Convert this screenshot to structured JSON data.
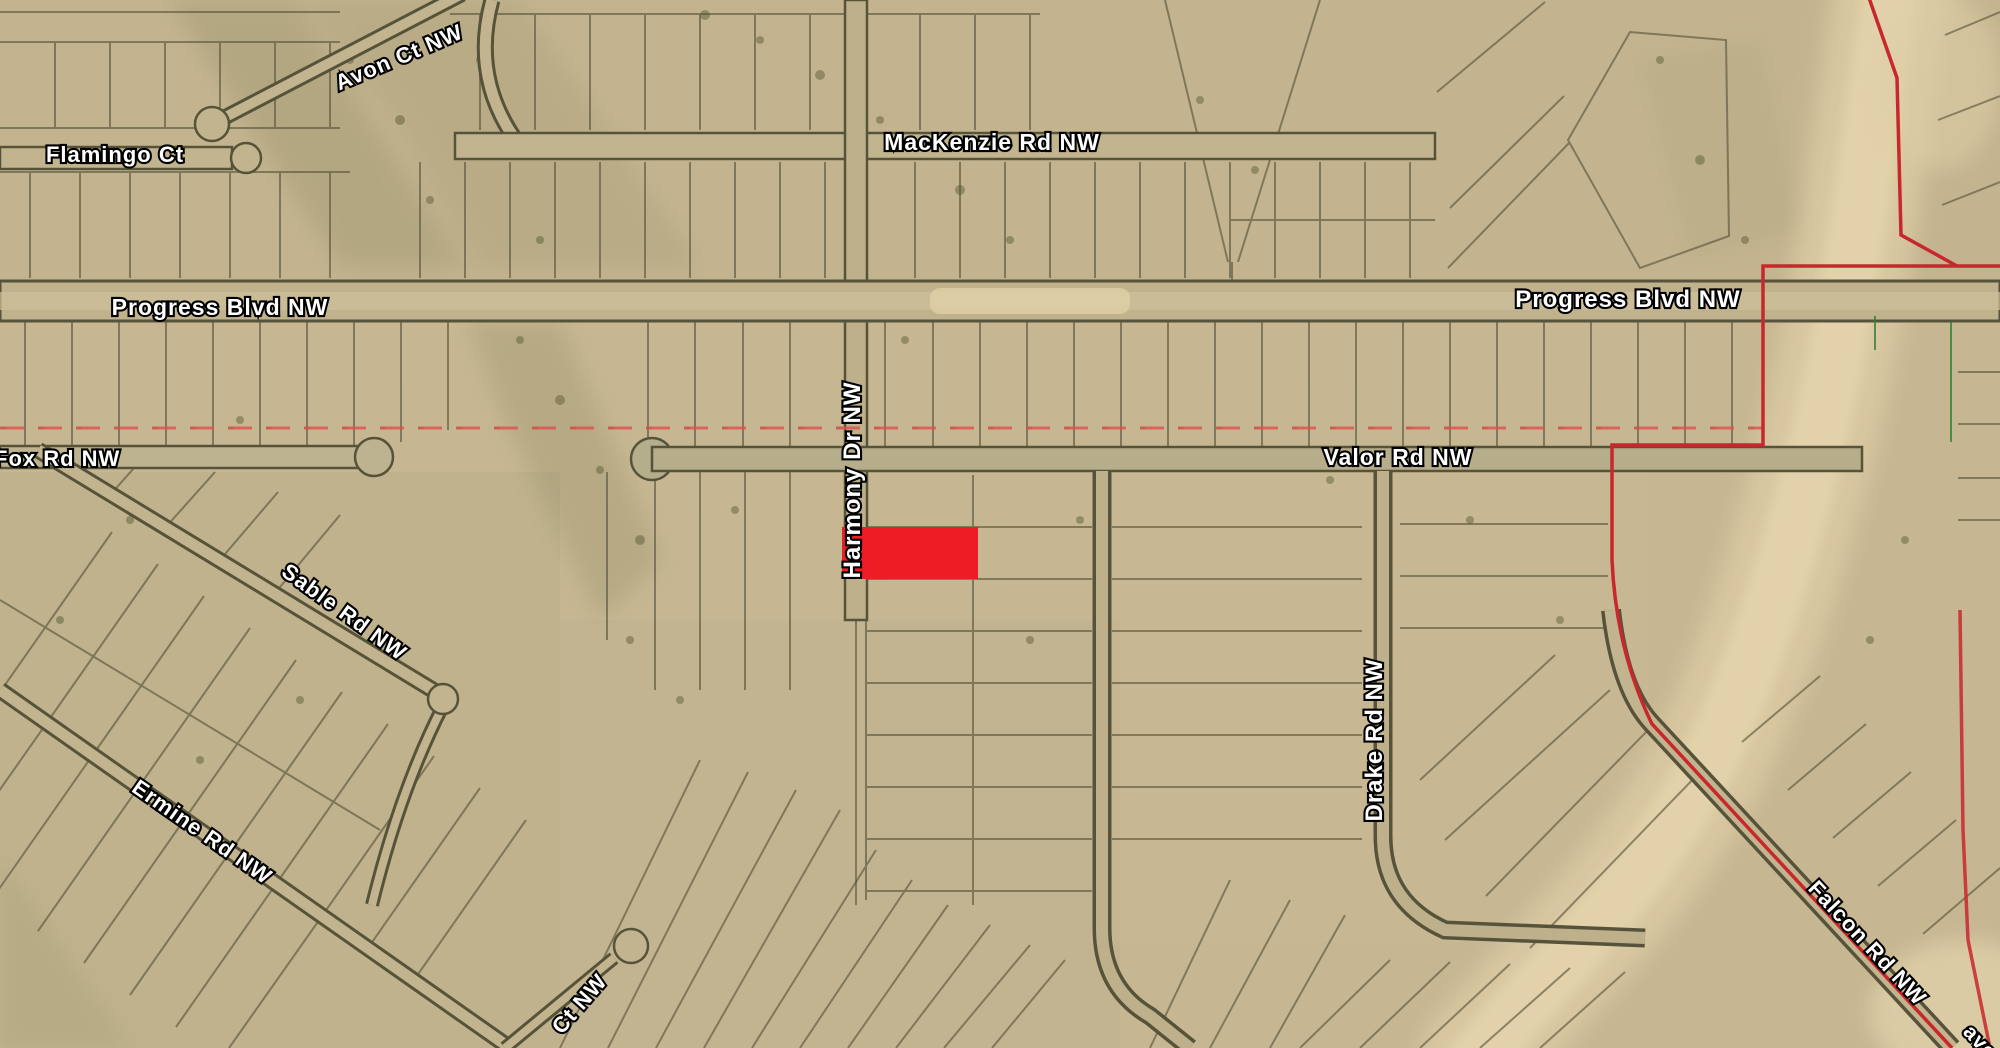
{
  "map": {
    "description": "aerial parcel plat map with highlighted lot",
    "highlight_color": "#ee1c24",
    "boundary_color": "#c8272c",
    "section_line_color": "#e0504e",
    "survey_tick_color": "#2f8032",
    "labels": {
      "flamingo_ct": "Flamingo Ct",
      "avon_ct": "Avon Ct NW",
      "mackenzie_rd": "MacKenzie Rd NW",
      "progress_blvd_left": "Progress Blvd NW",
      "progress_blvd_right": "Progress Blvd NW",
      "fox_rd": "Fox Rd NW",
      "valor_rd": "Valor Rd NW",
      "harmony_dr": "Harmony Dr NW",
      "sable_rd": "Sable Rd NW",
      "ermine_rd": "Ermine Rd NW",
      "drake_rd": "Drake Rd NW",
      "falcon_rd": "Falcon Rd NW",
      "ct_fragment": "Ct NW",
      "ave_fragment": "ave"
    }
  }
}
